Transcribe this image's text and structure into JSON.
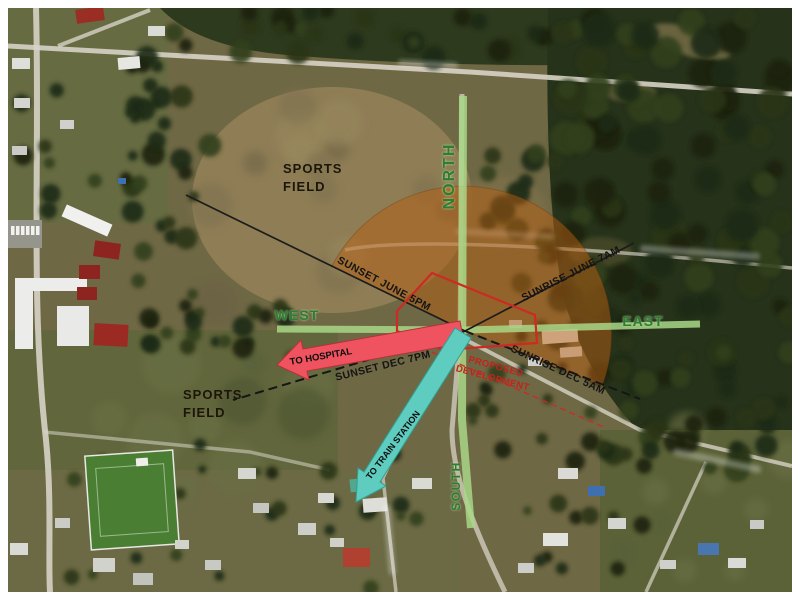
{
  "map": {
    "type": "aerial-site-analysis",
    "fields": {
      "upper_label": "SPORTS FIELD",
      "lower_label": "SPORTS FIELD",
      "ink_color": "#1c160a"
    },
    "compass": {
      "north": "NORTH",
      "south": "SOUTH",
      "east": "EAST",
      "west": "WEST",
      "axis_color": "#a9d787",
      "label_color": "#2f7d2f"
    },
    "sun_path": {
      "fan_color": "#b65e12",
      "line_color": "#1c1c1c",
      "labels": {
        "sunset_june": "SUNSET JUNE 5PM",
        "sunrise_june": "SUNRISE JUNE 7AM",
        "sunset_dec": "SUNSET DEC 7PM",
        "sunrise_dec": "SUNRISE DEC 5AM"
      }
    },
    "routes": {
      "hospital": {
        "label": "TO HOSPITAL",
        "color": "#ef5360"
      },
      "train": {
        "label": "TO TRAIN STATION",
        "color": "#5fccc0"
      }
    },
    "development": {
      "label": "PROPOSED DEVELOPMENT",
      "boundary_color": "#cc2a22"
    }
  }
}
